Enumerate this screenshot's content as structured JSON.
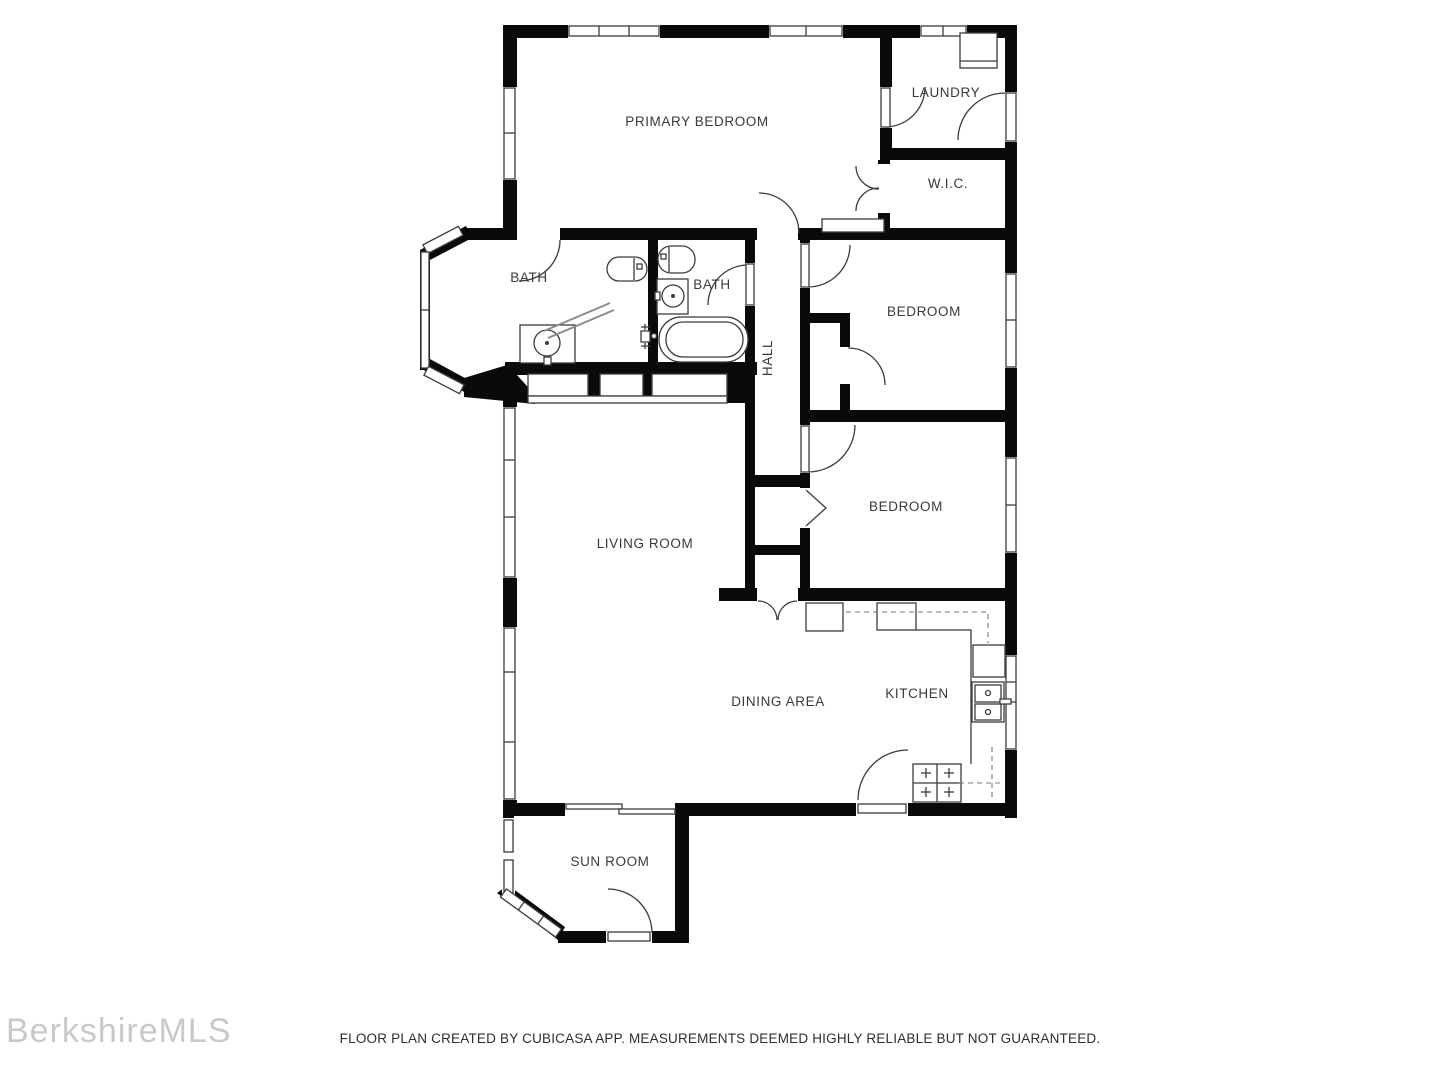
{
  "rooms": {
    "primary_bedroom": "PRIMARY BEDROOM",
    "laundry": "LAUNDRY",
    "wic": "W.I.C.",
    "bath_left": "BATH",
    "bath_right": "BATH",
    "hall": "HALL",
    "bedroom_upper": "BEDROOM",
    "bedroom_lower": "BEDROOM",
    "living_room": "LIVING ROOM",
    "dining_area": "DINING AREA",
    "kitchen": "KITCHEN",
    "sun_room": "SUN ROOM"
  },
  "watermark": "BerkshireMLS",
  "disclaimer": "FLOOR PLAN CREATED BY CUBICASA APP. MEASUREMENTS DEEMED HIGHLY RELIABLE BUT NOT GUARANTEED.",
  "colors": {
    "wall": "#0a0a0a",
    "background": "#ffffff",
    "label": "#3a3a3a",
    "watermark": "#c9c9c9",
    "fixture_line": "#3c3c3c"
  }
}
